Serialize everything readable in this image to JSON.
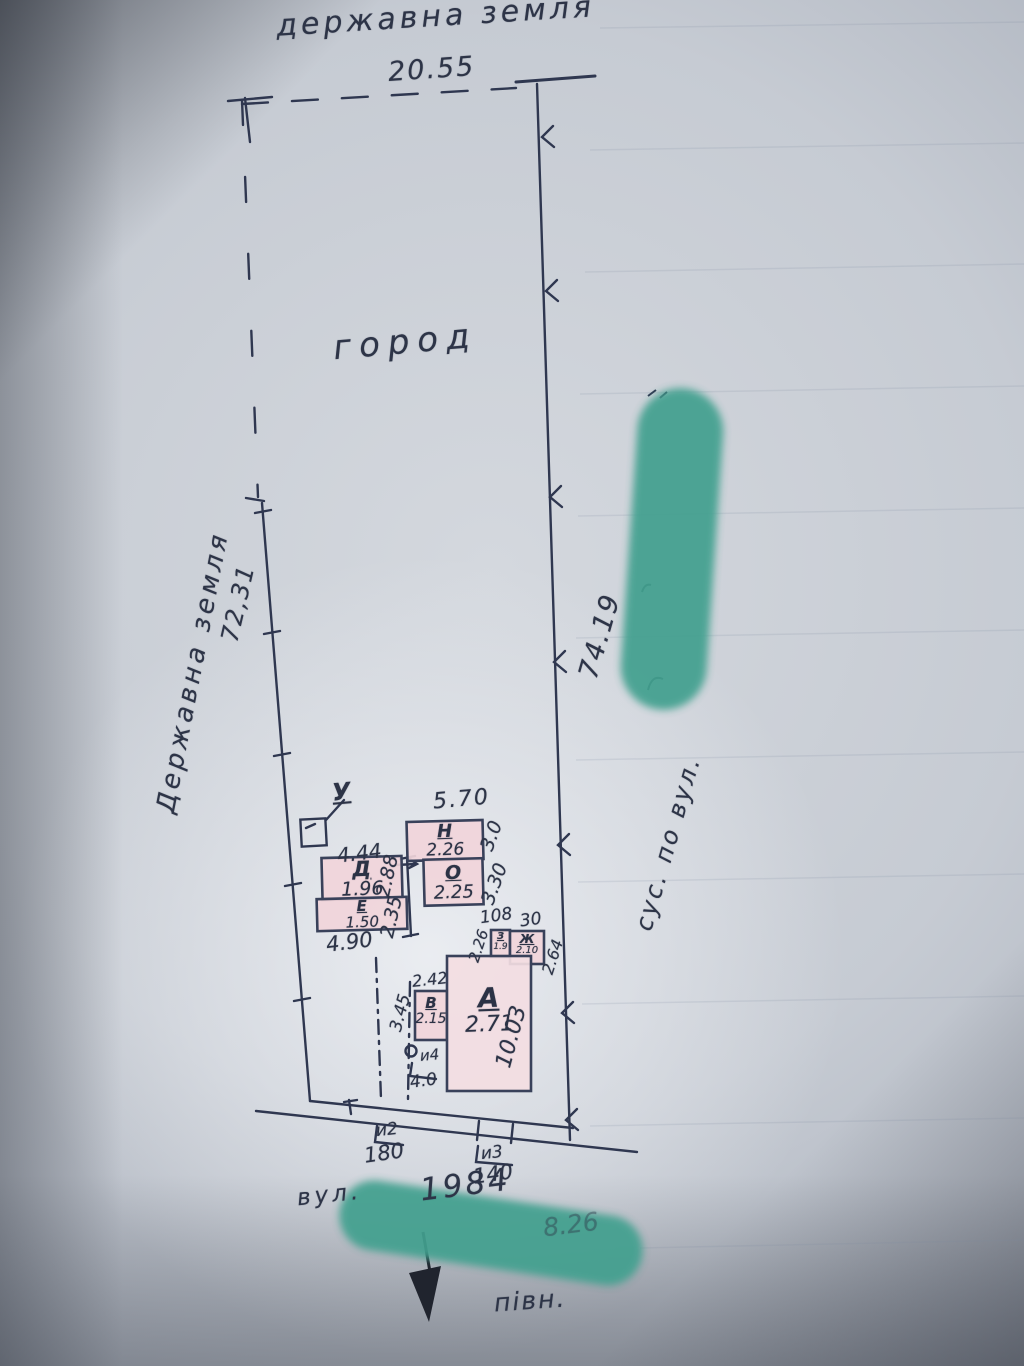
{
  "plan": {
    "areas": {
      "top_state_land": "державна земля",
      "left_state_land": "Державна земля",
      "garden": "город",
      "neighbor_right": "сус. по вул.",
      "street": "вул.",
      "year": "1984",
      "north": "півн."
    },
    "boundary_dims": {
      "top": "20.55",
      "left": "72,31",
      "right": "74.19",
      "street_front_faint": "8.26"
    },
    "well_label": "У",
    "buildings": [
      {
        "letter": "Д",
        "value": "1.96"
      },
      {
        "letter": "Е",
        "value": "1.50"
      },
      {
        "letter": "Н",
        "value": "2.26"
      },
      {
        "letter": "О",
        "value": "2.25"
      },
      {
        "letter": "З",
        "value": "1.9"
      },
      {
        "letter": "Ж",
        "value": "2.10"
      },
      {
        "letter": "В",
        "value": "2.15"
      },
      {
        "letter": "А",
        "value": "2.71"
      }
    ],
    "dims": {
      "d444": "4.44",
      "d288": "2.88",
      "d235": "2.35",
      "d490": "4.90",
      "d570": "5.70",
      "d30_top": "3.0",
      "d330": "3.30",
      "d108": "108",
      "d30_low": "30",
      "d226": "2.26",
      "d264": "2.64",
      "d242": "2.42",
      "d345": "3.45",
      "d1003": "10.03",
      "g2_label": "и2",
      "g2_value": "180",
      "g3_label": "и3",
      "g3_value": "140",
      "g4_label": "и4",
      "g4_value": "4.0"
    },
    "colors": {
      "ink": "#2e3547",
      "building_fill": "#f1d5da",
      "redaction_teal": "#43a08f"
    }
  }
}
